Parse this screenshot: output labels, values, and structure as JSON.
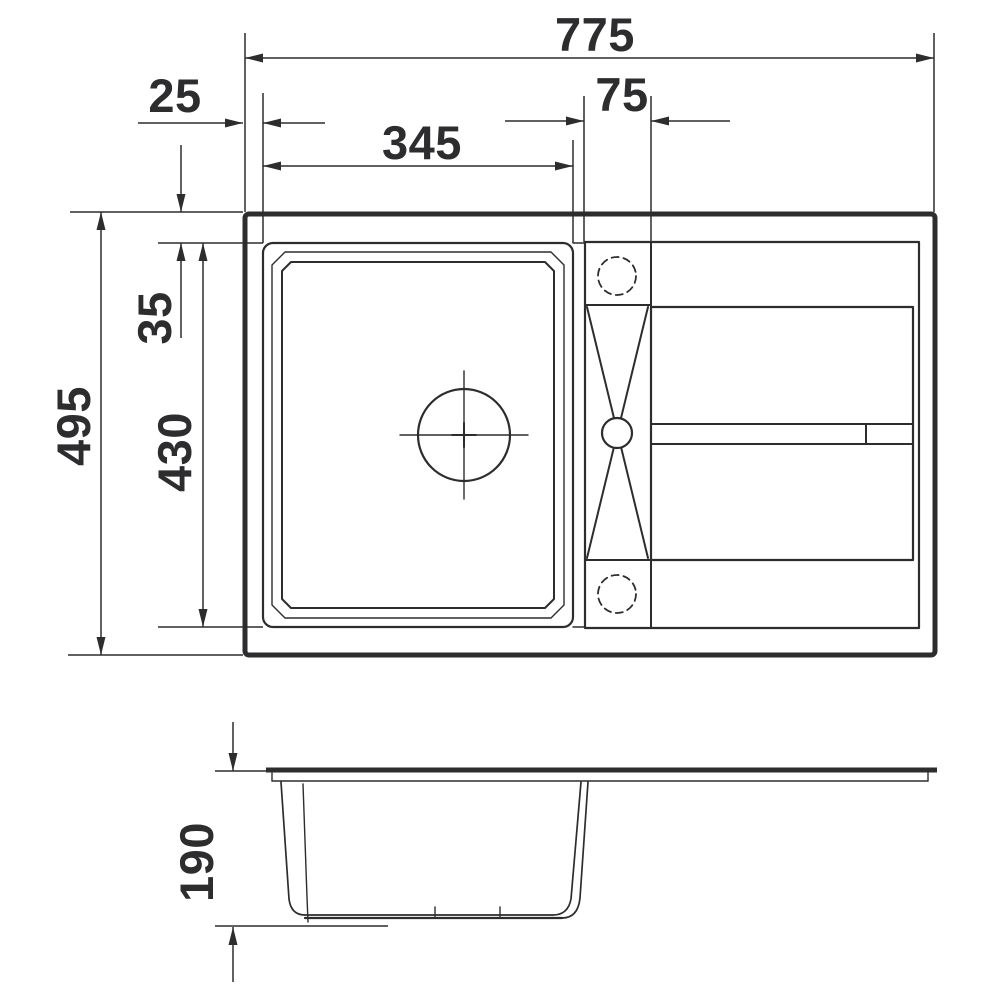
{
  "drawing": {
    "kind": "technical dimension drawing",
    "subject": "kitchen sink with single bowl, tap ledge and drainer board",
    "units": "mm",
    "background_color": "#ffffff",
    "line_color": "#2d2d2f",
    "views": {
      "plan": {
        "name": "top plan view"
      },
      "side": {
        "name": "side section view"
      }
    },
    "dimensions": {
      "overall_width": {
        "label": "775",
        "value": 775,
        "orientation": "horizontal",
        "view": "plan"
      },
      "left_offset": {
        "label": "25",
        "value": 25,
        "orientation": "horizontal",
        "view": "plan"
      },
      "bowl_width": {
        "label": "345",
        "value": 345,
        "orientation": "horizontal",
        "view": "plan"
      },
      "tap_ledge_width": {
        "label": "75",
        "value": 75,
        "orientation": "horizontal",
        "view": "plan"
      },
      "overall_depth": {
        "label": "495",
        "value": 495,
        "orientation": "vertical",
        "view": "plan"
      },
      "bowl_top_offset": {
        "label": "35",
        "value": 35,
        "orientation": "vertical",
        "view": "plan"
      },
      "bowl_length": {
        "label": "430",
        "value": 430,
        "orientation": "vertical",
        "view": "plan"
      },
      "bowl_height": {
        "label": "190",
        "value": 190,
        "orientation": "vertical",
        "view": "side"
      }
    }
  }
}
